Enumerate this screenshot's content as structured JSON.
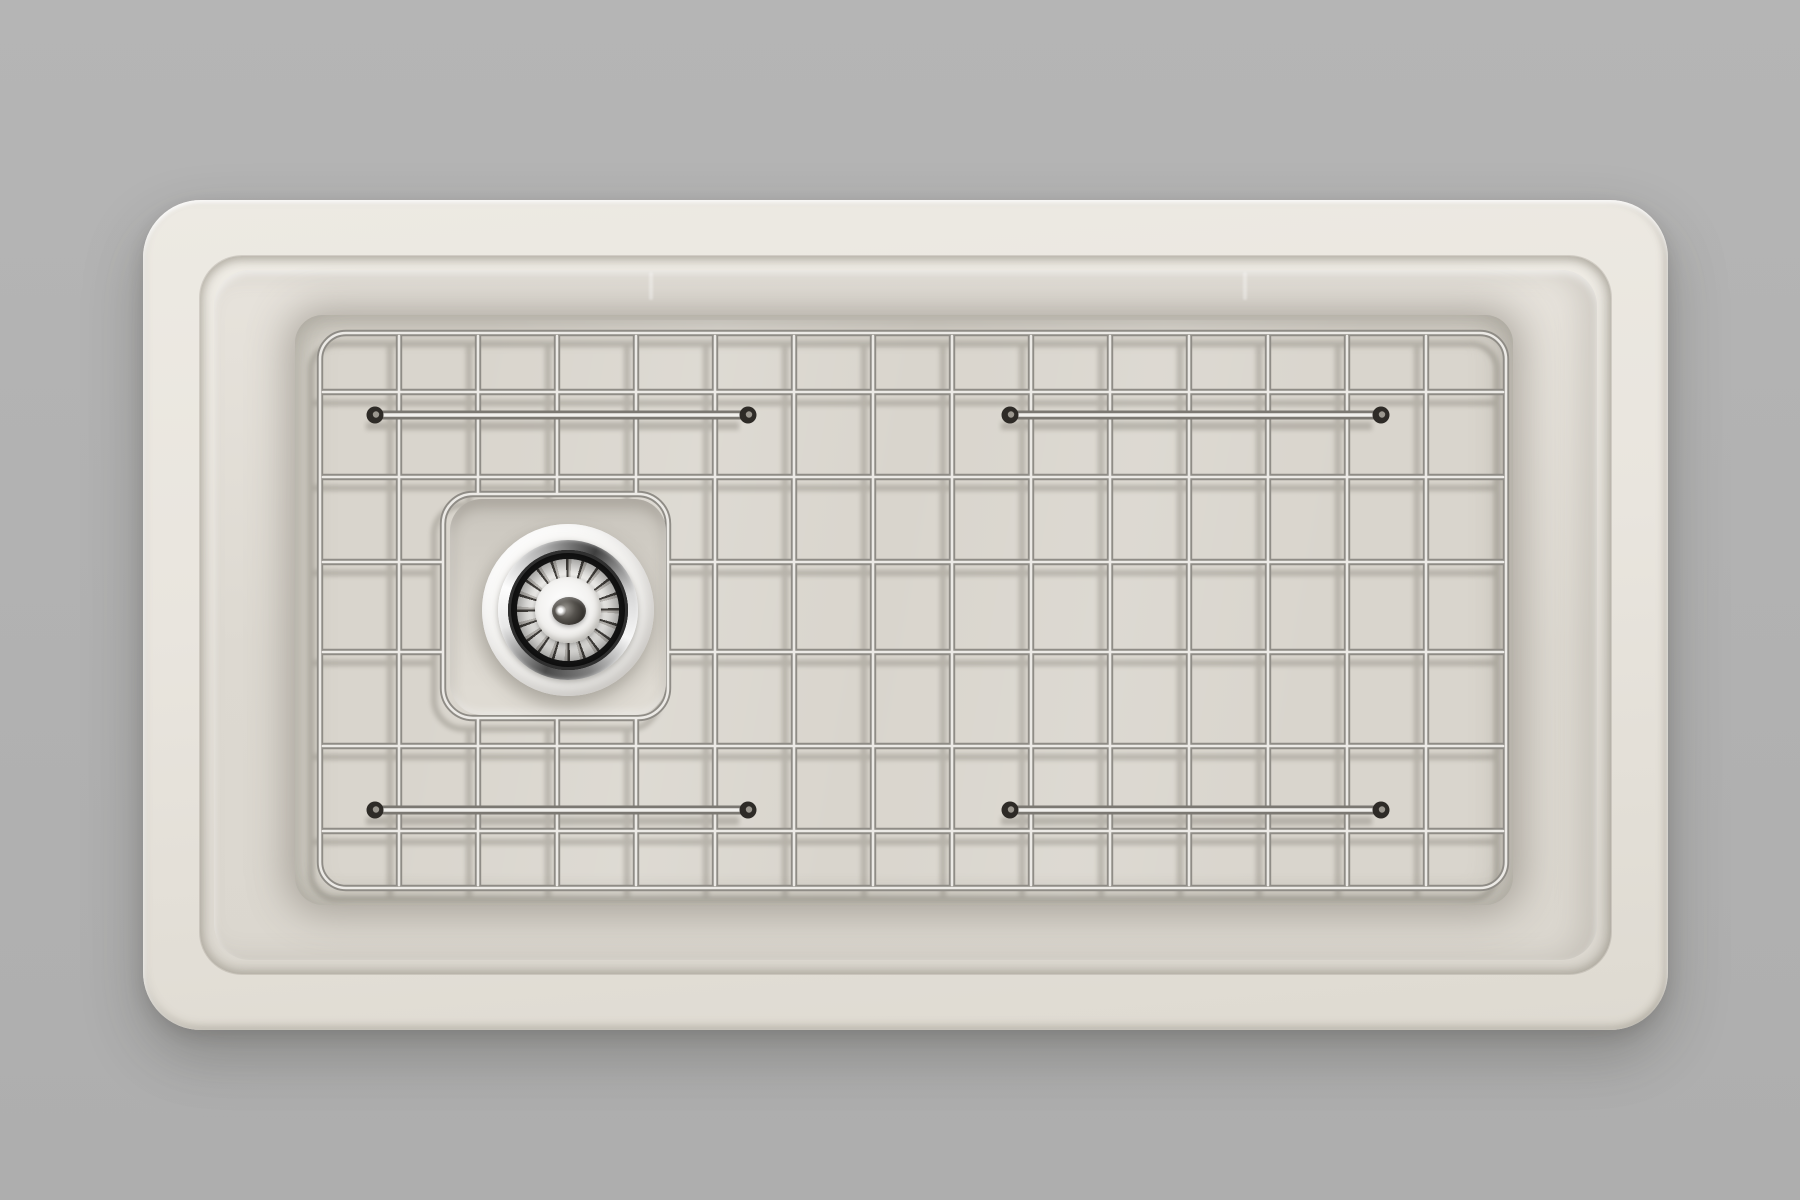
{
  "scene": {
    "kind": "product-render-top-view",
    "subject": "farmhouse kitchen sink with bottom grid and basket strainer drain",
    "background_color": "#b2b2b2",
    "sink": {
      "body_color": "#e9e5de",
      "rim_highlight_color": "#f0ece6",
      "drop_shadow_color": "rgba(40,38,34,0.28)"
    },
    "basin": {
      "wall_color": "#ddd9d1",
      "floor_color": "#d9d5cd"
    },
    "grid": {
      "columns": 15,
      "rows": 7,
      "wire_edge_color": "#8f8c86",
      "wire_highlight_color": "#eceae6",
      "shadow_color": "#6b665c",
      "foot_color": "#2e2b27",
      "foot_pin_color": "#9b978f",
      "border": {
        "x": 320,
        "y": 333,
        "w": 1186,
        "h": 555,
        "r": 26
      },
      "vertical_wires_x": [
        399,
        478,
        557,
        636,
        715,
        794,
        873,
        952,
        1031,
        1110,
        1189,
        1268,
        1347,
        1426
      ],
      "horizontal_wires_y": [
        392,
        477,
        562,
        652,
        746,
        831
      ],
      "cutout": {
        "x": 443,
        "y": 494,
        "w": 225,
        "h": 224,
        "r": 30
      },
      "runners": [
        {
          "x1": 375,
          "x2": 748,
          "y": 415
        },
        {
          "x1": 1010,
          "x2": 1381,
          "y": 415
        },
        {
          "x1": 375,
          "x2": 748,
          "y": 810
        },
        {
          "x1": 1010,
          "x2": 1381,
          "y": 810
        }
      ]
    },
    "drain": {
      "center_x": 568,
      "center_y": 610,
      "recess_color": "#d2cec6",
      "flange_color": "#f5f4f2",
      "well_color": "#151515",
      "teeth_count": 20,
      "knob_color": "#312e2a"
    }
  }
}
